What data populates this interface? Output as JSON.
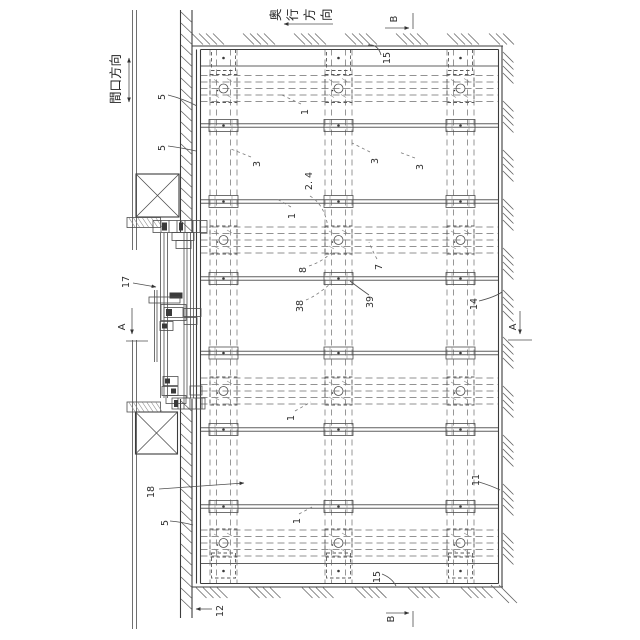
{
  "drawing": {
    "type": "patent-floor-framing-plan",
    "background": "#ffffff",
    "ink": "#3f3f3f"
  },
  "labels": {
    "depth_direction": "奥行方向",
    "frontage_direction": "間口方向",
    "section_a": "A",
    "section_b": "B",
    "callouts": {
      "c1": "1",
      "c2_4": "2. 4",
      "c3": "3",
      "c5": "5",
      "c7": "7",
      "c8": "8",
      "c11": "11",
      "c12": "12",
      "c14": "14",
      "c15": "15",
      "c17": "17",
      "c18": "18",
      "c38": "38",
      "c39": "39"
    }
  }
}
